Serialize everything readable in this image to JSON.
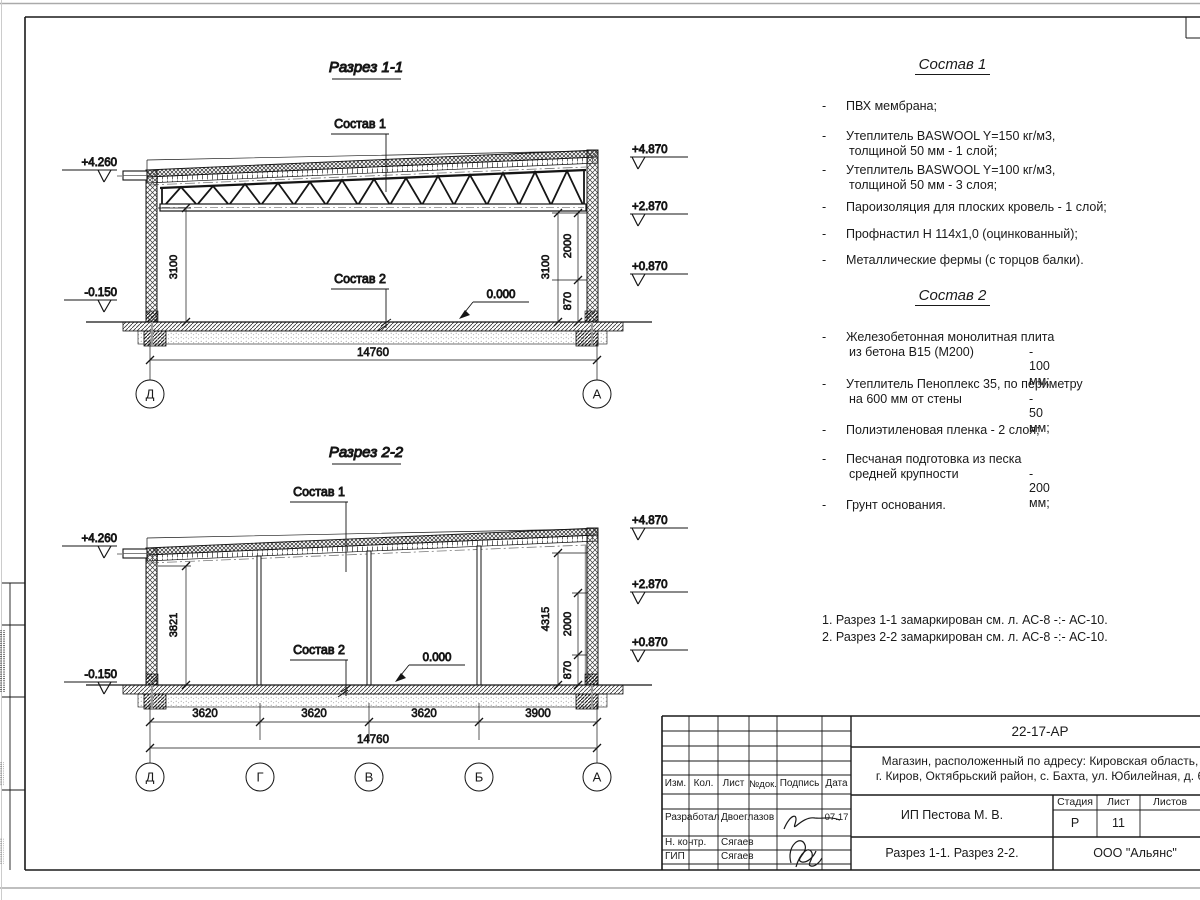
{
  "section1": {
    "title": "Разрез 1-1",
    "sostav1_label": "Состав 1",
    "sostav2_label": "Состав 2",
    "elev": {
      "lt": "+4.260",
      "lb": "-0.150",
      "rt": "+4.870",
      "rm": "+2.870",
      "rb": "+0.870",
      "floor": "0.000"
    },
    "dims": {
      "left": "3100",
      "right": "3100",
      "d2000": "2000",
      "d870": "870",
      "total": "14760"
    },
    "axes": [
      "Д",
      "А"
    ]
  },
  "section2": {
    "title": "Разрез 2-2",
    "sostav1_label": "Состав 1",
    "sostav2_label": "Состав 2",
    "elev": {
      "lt": "+4.260",
      "lb": "-0.150",
      "rt": "+4.870",
      "rm": "+2.870",
      "rb": "+0.870",
      "floor": "0.000"
    },
    "dims": {
      "left": "3821",
      "right": "4315",
      "d2000": "2000",
      "d870": "870",
      "spans": [
        "3620",
        "3620",
        "3620",
        "3900"
      ],
      "total": "14760"
    },
    "axes": [
      "Д",
      "Г",
      "В",
      "Б",
      "А"
    ]
  },
  "sostav1": {
    "title": "Состав 1",
    "items": [
      {
        "line1": "ПВХ мембрана;"
      },
      {
        "line1": "Утеплитель BASWOOL Y=150 кг/м3,",
        "line2": "толщиной 50 мм - 1 слой;"
      },
      {
        "line1": "Утеплитель BASWOOL Y=100 кг/м3,",
        "line2": "толщиной 50 мм - 3 слоя;"
      },
      {
        "line1": "Пароизоляция для плоских кровель - 1 слой;"
      },
      {
        "line1": "Профнастил Н 114х1,0 (оцинкованный);"
      },
      {
        "line1": "Металлические фермы (с торцов балки)."
      }
    ]
  },
  "sostav2": {
    "title": "Состав 2",
    "items": [
      {
        "line1": "Железобетонная  монолитная плита",
        "line2": "из бетона В15 (М200)",
        "value": "- 100 мм;"
      },
      {
        "line1": "Утеплитель Пеноплекс 35, по периметру",
        "line2": "на 600 мм от стены",
        "value": "- 50 мм;"
      },
      {
        "line1": "Полиэтиленовая пленка - 2 слоя;"
      },
      {
        "line1": "Песчаная подготовка из песка",
        "line2": "средней крупности",
        "value": "- 200 мм;"
      },
      {
        "line1": "Грунт основания."
      }
    ]
  },
  "notes": [
    "1. Разрез 1-1 замаркирован см. л. АС-8 -:- АС-10.",
    "2. Разрез 2-2 замаркирован см. л. АС-8 -:- АС-10."
  ],
  "titleblock": {
    "doc_code": "22-17-АР",
    "project_line1": "Магазин, расположенный по адресу: Кировская область,",
    "project_line2": "г. Киров, Октябрьский район, с. Бахта, ул. Юбилейная, д. 6",
    "headers": {
      "izm": "Изм.",
      "kol": "Кол.",
      "list": "Лист",
      "ndok": "№док.",
      "podpis": "Подпись",
      "data": "Дата"
    },
    "rows": [
      {
        "role": "Разработал",
        "name": "Двоеглазов",
        "date": "07.17"
      },
      {
        "role": "Н. контр.",
        "name": "Сягаев"
      },
      {
        "role": "ГИП",
        "name": "Сягаев"
      }
    ],
    "client": "ИП Пестова М. В.",
    "stage_label": "Стадия",
    "sheet_label": "Лист",
    "sheets_label": "Листов",
    "stage": "Р",
    "sheet": "11",
    "sheet_title": "Разрез 1-1. Разрез 2-2.",
    "org": "ООО \"Альянс\""
  }
}
